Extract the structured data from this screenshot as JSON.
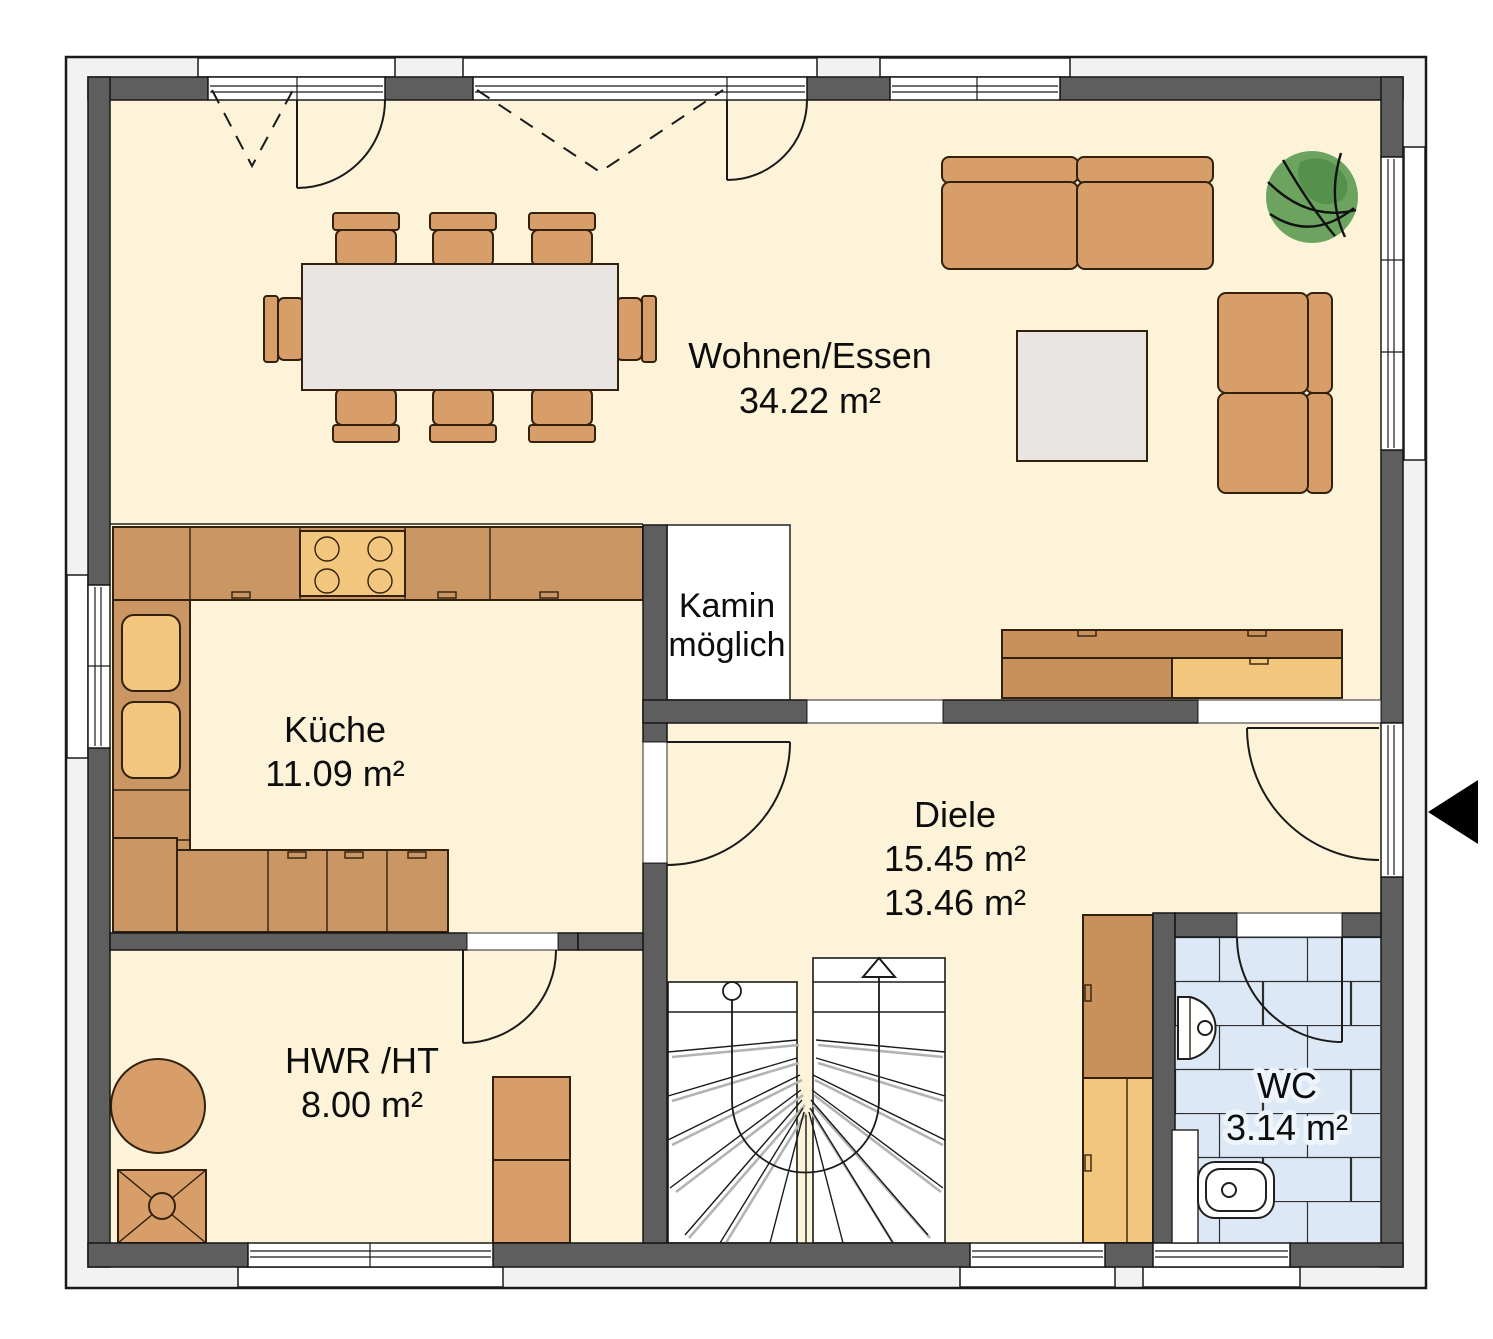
{
  "rooms": {
    "wohnen": {
      "name": "Wohnen/Essen",
      "area": "34.22 m²"
    },
    "kueche": {
      "name": "Küche",
      "area": "11.09 m²"
    },
    "kamin": {
      "line1": "Kamin",
      "line2": "möglich"
    },
    "diele": {
      "name": "Diele",
      "area1": "15.45 m²",
      "area2": "13.46 m²"
    },
    "hwr": {
      "name": "HWR /HT",
      "area": "8.00 m²"
    },
    "wc": {
      "name": "WC",
      "area": "3.14 m²"
    }
  },
  "colors": {
    "floor": "#fcf3d8",
    "wall": "#5e5e5e",
    "outer_band": "#f2f2f2",
    "furniture": "#d89e6a",
    "furniture_dark": "#c8905a",
    "furniture_light": "#f3c67e",
    "counter": "#ca9764",
    "table": "#e9e5e2",
    "tile": "#dce8f6",
    "stair": "#ffffff",
    "plant": "#6ca45f",
    "plant_dark": "#55914c",
    "arrow": "#000000"
  }
}
